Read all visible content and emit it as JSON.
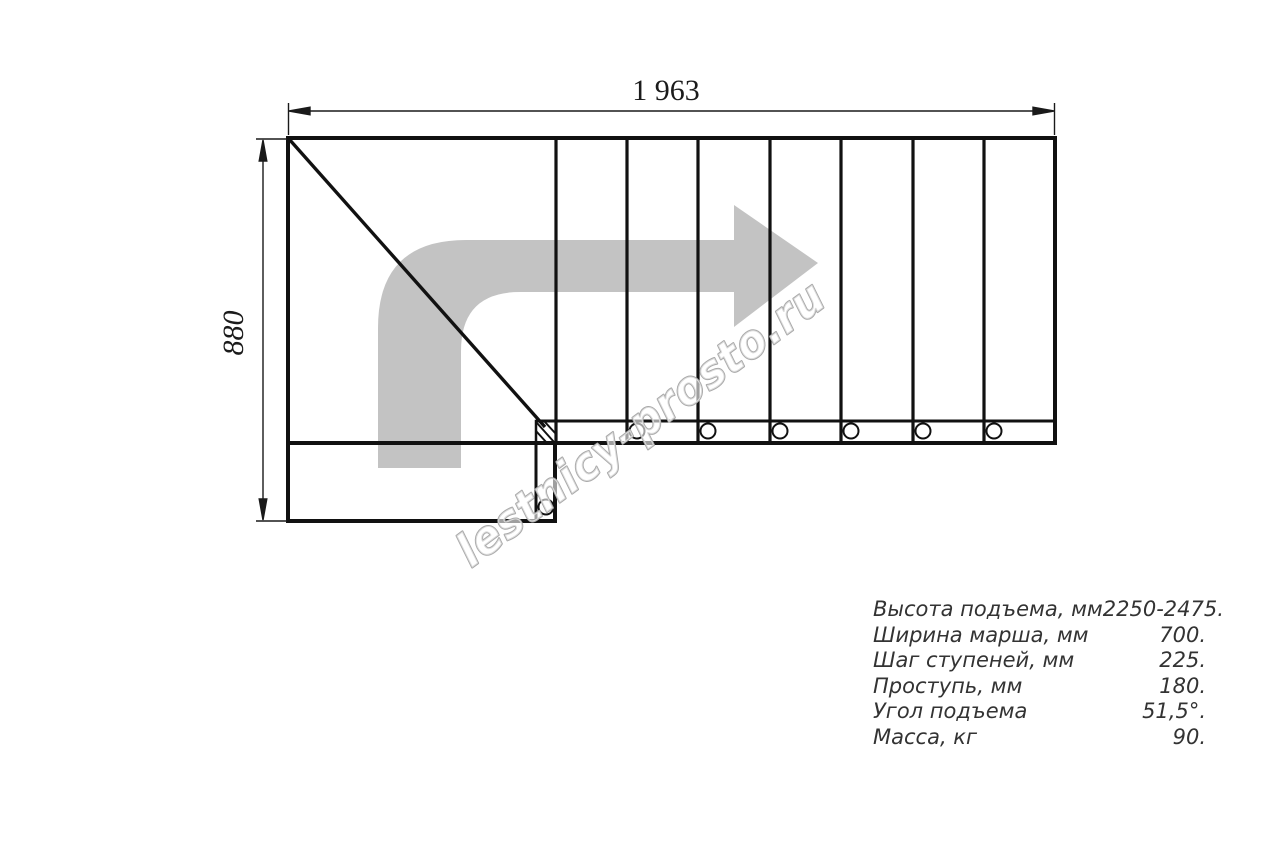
{
  "drawing": {
    "dimension_top": "1 963",
    "dimension_left": "880",
    "watermark": "lestnicy-prosto.ru"
  },
  "icons": {
    "direction_arrow": "curved-right-arrow"
  },
  "specs": {
    "rows": [
      {
        "label": "Высота подъема, мм",
        "value": "2250-2475."
      },
      {
        "label": "Ширина марша, мм",
        "value": "700."
      },
      {
        "label": "Шаг ступеней, мм",
        "value": "225."
      },
      {
        "label": "Проступь, мм",
        "value": "180."
      },
      {
        "label": "Угол подъема",
        "value": "51,5°."
      },
      {
        "label": "Масса, кг",
        "value": "90."
      }
    ]
  },
  "colors": {
    "line": "#111111",
    "dimension_line": "#1a1a1a",
    "arrow_fill": "#c3c3c3",
    "watermark_outline": "#a9a9a9",
    "spec_text": "#333333"
  }
}
